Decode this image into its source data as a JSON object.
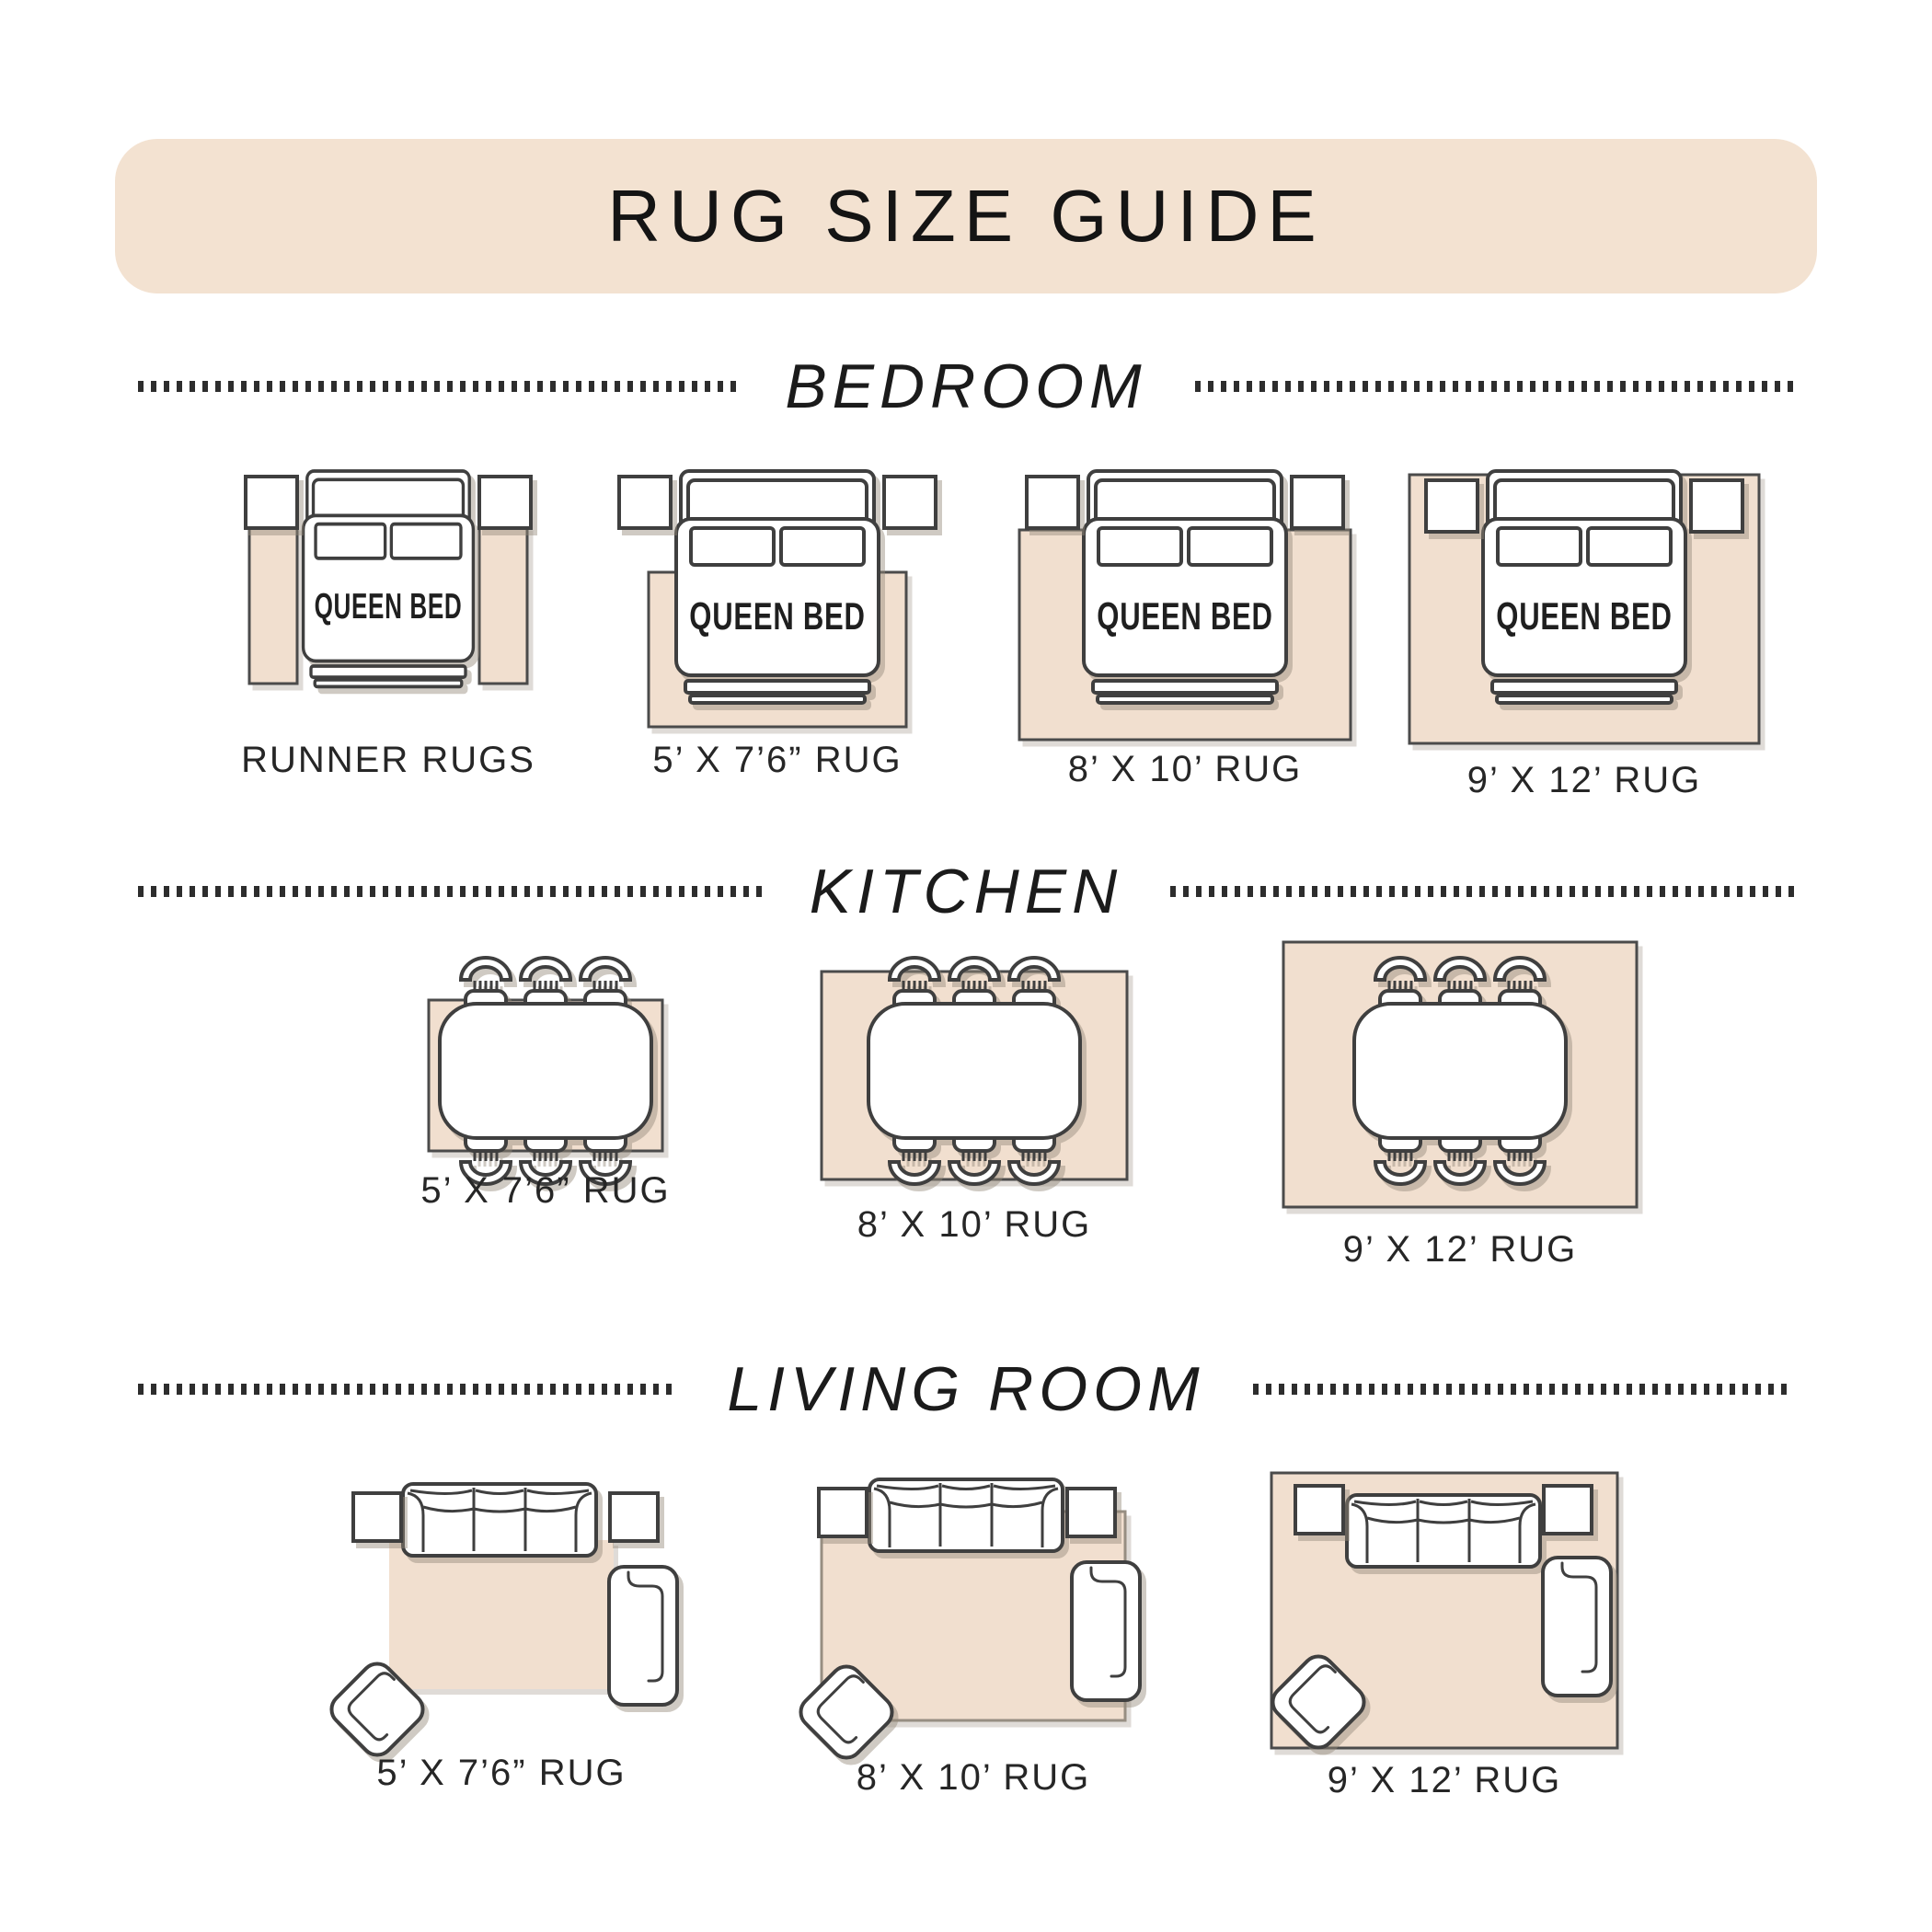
{
  "title": "RUG SIZE GUIDE",
  "bed_label": "QUEEN BED",
  "colors": {
    "banner_beige": "#f3e2d1",
    "rug_beige": "#f1dfcf",
    "outline_dark": "#3f3f3f",
    "shadow_gray": "#b7aea3",
    "text_dark": "#262626"
  },
  "sections": {
    "bedroom": {
      "label": "BEDROOM",
      "items": [
        {
          "label": "RUNNER RUGS"
        },
        {
          "label": "5’ X 7’6” RUG"
        },
        {
          "label": "8’ X 10’ RUG"
        },
        {
          "label": "9’ X 12’ RUG"
        }
      ]
    },
    "kitchen": {
      "label": "KITCHEN",
      "items": [
        {
          "label": "5’ X 7’6” RUG"
        },
        {
          "label": "8’ X 10’ RUG"
        },
        {
          "label": "9’ X 12’ RUG"
        }
      ]
    },
    "living_room": {
      "label": "LIVING ROOM",
      "items": [
        {
          "label": "5’ X 7’6” RUG"
        },
        {
          "label": "8’ X 10’ RUG"
        },
        {
          "label": "9’ X 12’ RUG"
        }
      ]
    }
  }
}
